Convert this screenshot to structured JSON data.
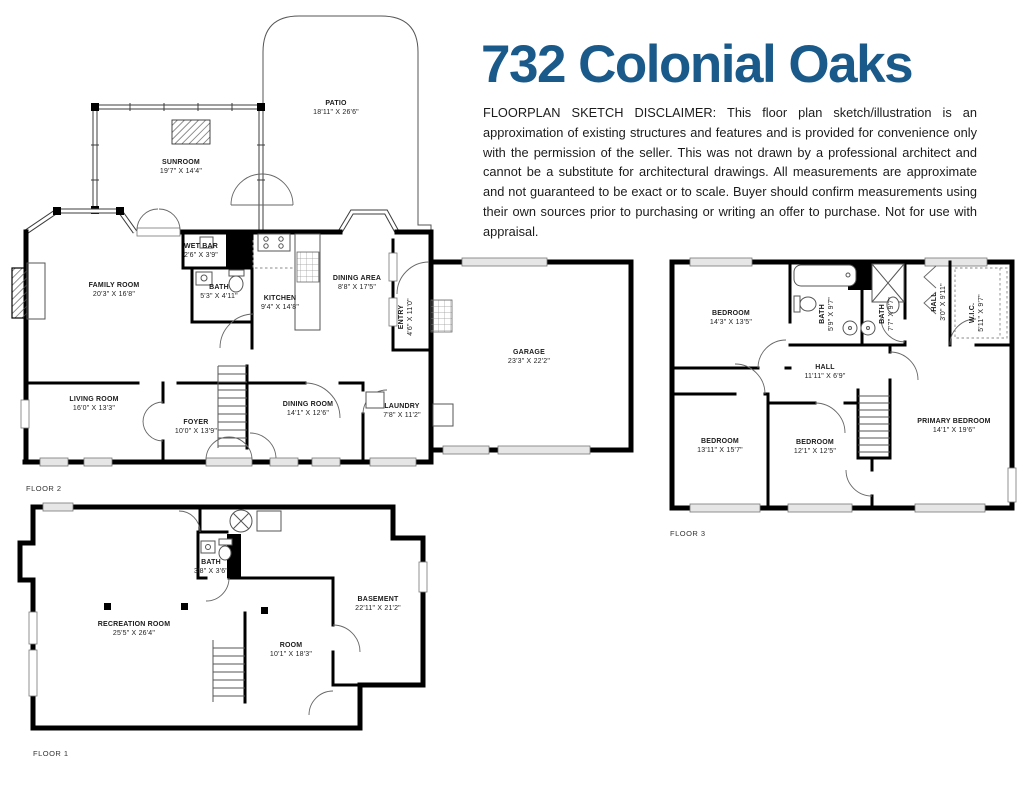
{
  "title": "732 Colonial Oaks",
  "disclaimer": "FLOORPLAN SKETCH DISCLAIMER: This floor plan sketch/illustration is an approximation of existing structures and features and is provided for convenience only with the permission of the seller. This was not drawn by a professional architect and cannot be a substitute for architectural drawings. All measurements are approximate and not guaranteed to be exact or to scale. Buyer should confirm measurements using their own sources prior to purchasing or writing an offer to purchase. Not for use with appraisal.",
  "colors": {
    "title_blue": "#1a5a8a",
    "wall_black": "#000000"
  },
  "floors": [
    {
      "label": "FLOOR 2",
      "rooms": [
        {
          "name": "PATIO",
          "dims": "18'11\" X 26'6\""
        },
        {
          "name": "SUNROOM",
          "dims": "19'7\" X 14'4\""
        },
        {
          "name": "WET BAR",
          "dims": "2'6\" X 3'9\""
        },
        {
          "name": "BATH",
          "dims": "5'3\" X 4'11\""
        },
        {
          "name": "KITCHEN",
          "dims": "9'4\" X 14'8\""
        },
        {
          "name": "DINING AREA",
          "dims": "8'8\" X 17'5\""
        },
        {
          "name": "FAMILY ROOM",
          "dims": "20'3\" X 16'8\""
        },
        {
          "name": "ENTRY",
          "dims": "4'6\" X 11'0\""
        },
        {
          "name": "GARAGE",
          "dims": "23'3\" X 22'2\""
        },
        {
          "name": "LIVING ROOM",
          "dims": "16'0\" X 13'3\""
        },
        {
          "name": "FOYER",
          "dims": "10'0\" X 13'9\""
        },
        {
          "name": "DINING ROOM",
          "dims": "14'1\" X 12'6\""
        },
        {
          "name": "LAUNDRY",
          "dims": "7'8\" X 11'2\""
        }
      ]
    },
    {
      "label": "FLOOR 3",
      "rooms": [
        {
          "name": "BEDROOM",
          "dims": "14'3\" X 13'5\""
        },
        {
          "name": "BATH",
          "dims": "5'9\" X 9'7\""
        },
        {
          "name": "BATH",
          "dims": "7'7\" X 9'7\""
        },
        {
          "name": "HALL",
          "dims": "3'0\" X 9'11\""
        },
        {
          "name": "W.I.C.",
          "dims": "5'11\" X 9'7\""
        },
        {
          "name": "HALL",
          "dims": "11'11\" X 6'9\""
        },
        {
          "name": "BEDROOM",
          "dims": "13'11\" X 15'7\""
        },
        {
          "name": "BEDROOM",
          "dims": "12'1\" X 12'5\""
        },
        {
          "name": "PRIMARY BEDROOM",
          "dims": "14'1\" X 19'6\""
        }
      ]
    },
    {
      "label": "FLOOR 1",
      "rooms": [
        {
          "name": "RECREATION ROOM",
          "dims": "25'5\" X 26'4\""
        },
        {
          "name": "BATH",
          "dims": "3'8\" X 3'6\""
        },
        {
          "name": "ROOM",
          "dims": "10'1\" X 18'3\""
        },
        {
          "name": "BASEMENT",
          "dims": "22'11\" X 21'2\""
        }
      ]
    }
  ]
}
